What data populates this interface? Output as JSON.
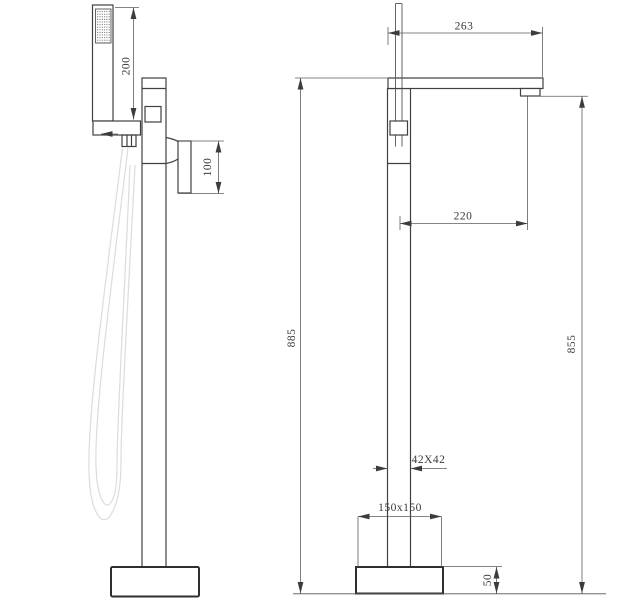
{
  "drawing": {
    "kind": "freestanding-faucet-two-view-dimension-drawing",
    "dimensions": {
      "hand_shower_length": "200",
      "handle_length": "100",
      "spout_reach_overall": "263",
      "spout_reach_outlet": "220",
      "overall_height": "885",
      "spout_outlet_height": "855",
      "column_section": "42X42",
      "base_plate": "150x150",
      "base_thickness": "50"
    },
    "colors": {
      "outline": "#404040",
      "dimension_lines": "#5d5d5d",
      "hose": "#dcdcdc",
      "background": "#ffffff"
    }
  }
}
